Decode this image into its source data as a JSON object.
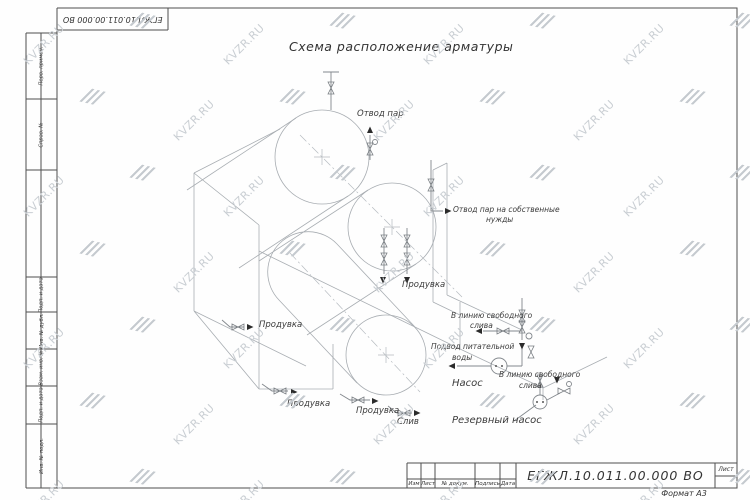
{
  "watermark": {
    "text": "KVZR.RU"
  },
  "frame": {
    "stamp_top": "ЕГЖЛ.10.011.00.000  ВО",
    "sidebar_top": [
      "Перв. примен.",
      "Справ. №"
    ],
    "sidebar_bottom": [
      "Подп. и дата",
      "Инв. № дубл.",
      "Взам. инв. №",
      "Подп. и дата",
      "Инв. № подл."
    ]
  },
  "drawing": {
    "title": "Схема расположение арматуры",
    "labels": [
      {
        "text": "Отвод пар",
        "x": 357,
        "y": 110
      },
      {
        "text": "Отвод пар на собственные",
        "x": 453,
        "y": 206,
        "size": 7.5
      },
      {
        "text": "нужды",
        "x": 486,
        "y": 216,
        "size": 7.5
      },
      {
        "text": "Продувка",
        "x": 402,
        "y": 281
      },
      {
        "text": "В линию свободного",
        "x": 451,
        "y": 312,
        "size": 7.5
      },
      {
        "text": "слива",
        "x": 470,
        "y": 322,
        "size": 7.5
      },
      {
        "text": "Подвод питательной",
        "x": 431,
        "y": 343,
        "size": 7.5
      },
      {
        "text": "воды",
        "x": 452,
        "y": 354,
        "size": 7.5
      },
      {
        "text": "Насос",
        "x": 452,
        "y": 379,
        "size": 10
      },
      {
        "text": "В линию свободного",
        "x": 499,
        "y": 371,
        "size": 7.5
      },
      {
        "text": "слива",
        "x": 519,
        "y": 382,
        "size": 7.5
      },
      {
        "text": "Продувка",
        "x": 259,
        "y": 321
      },
      {
        "text": "Продувка",
        "x": 287,
        "y": 400
      },
      {
        "text": "Продувка",
        "x": 356,
        "y": 407
      },
      {
        "text": "Слив",
        "x": 397,
        "y": 418
      },
      {
        "text": "Резервный насос",
        "x": 452,
        "y": 416,
        "size": 10
      }
    ]
  },
  "title_block": {
    "designation": "ЕГЖЛ.10.011.00.000  ВО",
    "header_cells": [
      "Изм",
      "Лист",
      "№ докум.",
      "Подпись",
      "Дата"
    ],
    "sheet_label": "Лист",
    "sheet_value": "",
    "format_label": "Формат А3"
  }
}
